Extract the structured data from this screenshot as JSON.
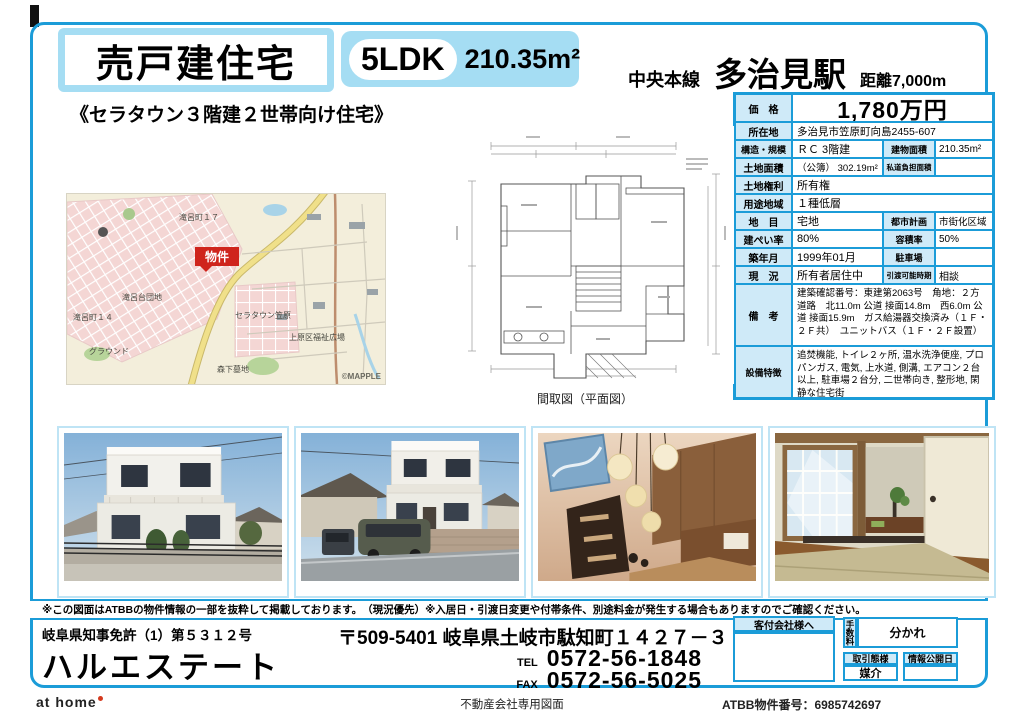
{
  "header": {
    "property_type": "売戸建住宅",
    "layout": "5LDK",
    "building_area": "210.35m²",
    "rail_line": "中央本線",
    "station": "多治見駅",
    "distance": "距離7,000m",
    "catch_copy": "《セラタウン３階建２世帯向け住宅》"
  },
  "spec_table": {
    "price": {
      "label": "価　格",
      "value": "1,780万円"
    },
    "location": {
      "label": "所在地",
      "value": "多治見市笠原町向島2455-607"
    },
    "structure": {
      "label": "構造・規模",
      "value": "ＲＣ 3階建"
    },
    "building_area": {
      "label": "建物面積",
      "value": "210.35m²"
    },
    "land_area": {
      "label": "土地面積",
      "value": "（公簿） 302.19m²"
    },
    "private_road": {
      "label": "私道負担面積",
      "value": ""
    },
    "land_rights": {
      "label": "土地権利",
      "value": "所有権"
    },
    "use_district": {
      "label": "用途地域",
      "value": "１種低層"
    },
    "land_category": {
      "label": "地　目",
      "value": "宅地"
    },
    "city_planning": {
      "label": "都市計画",
      "value": "市街化区域"
    },
    "coverage_ratio": {
      "label": "建ぺい率",
      "value": "80%"
    },
    "floor_area_ratio": {
      "label": "容積率",
      "value": "50%"
    },
    "built_date": {
      "label": "築年月",
      "value": "1999年01月"
    },
    "parking": {
      "label": "駐車場",
      "value": ""
    },
    "current_status": {
      "label": "現　況",
      "value": "所有者居住中"
    },
    "handover": {
      "label": "引渡可能時期",
      "value": "相談"
    },
    "remarks": {
      "label": "備　考",
      "value": "建築確認番号：東建第2063号　角地：２方道路　北11.0m 公道 接面14.8m　西6.0m 公道 接面15.9m　ガス給湯器交換済み（１Ｆ・２Ｆ共）　ユニットバス（１Ｆ・２Ｆ設置）"
    },
    "features": {
      "label": "設備特徴",
      "value": "追焚機能, トイレ２ヶ所, 温水洗浄便座, プロパンガス, 電気, 上水道, 側溝, エアコン２台以上, 駐車場２台分, 二世帯向き, 整形地, 閑静な住宅街"
    }
  },
  "map": {
    "marker": "物件",
    "labels": [
      "滝呂町１７",
      "滝呂台団地",
      "滝呂町１４",
      "グラウンド",
      "セラタウン笠原",
      "森下墓地",
      "上原区福祉広場"
    ],
    "credit": "©MAPPLE"
  },
  "floor_plan": {
    "caption": "間取図（平面図）"
  },
  "disclaimer": "※この図面はATBBの物件情報の一部を抜粋して掲載しております。　（現況優先）※入居日・引渡日変更や付帯条件、別途料金が発生する場合もありますのでご確認ください。",
  "agency": {
    "license": "岐阜県知事免許（1）第５３１２号",
    "name": "ハルエステート",
    "address": "〒509-5401 岐阜県土岐市駄知町１４２７－３",
    "tel_label": "TEL",
    "tel": "0572-56-1848",
    "fax_label": "FAX",
    "fax": "0572-56-5025"
  },
  "broker_box": {
    "client_header": "客付会社様へ",
    "fee_label": "手数料",
    "fee_value": "分かれ",
    "transaction_label": "取引態様",
    "transaction_value": "媒介",
    "publish_label": "情報公開日",
    "publish_value": ""
  },
  "bottom_bar": {
    "athome_logo": "at home",
    "document_type": "不動産会社専用図面",
    "atbb_number": "ATBB物件番号：6985742697"
  },
  "colors": {
    "accent_blue": "#1b9cd8",
    "light_blue_fill": "#a5ddf3",
    "table_label_fill": "#cfeaf8",
    "marker_red": "#cf241c"
  }
}
